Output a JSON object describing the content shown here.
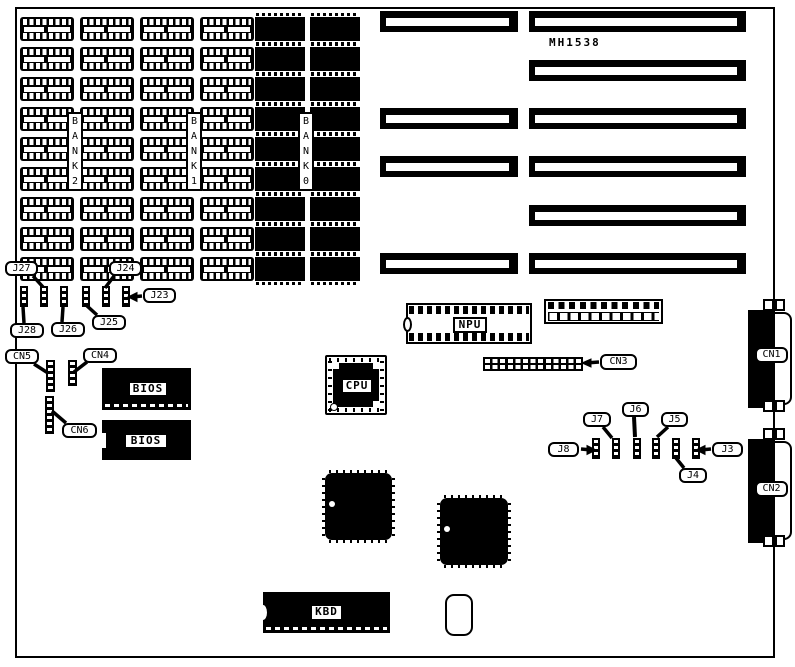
{
  "diagram": {
    "model": "MH1538",
    "memory": {
      "banks": [
        {
          "id": "bank2",
          "label": "BANK2"
        },
        {
          "id": "bank1",
          "label": "BANK1"
        },
        {
          "id": "bank0",
          "label": "BANK0"
        }
      ],
      "empty_socket_grid": {
        "rows": 9,
        "cols": 4
      },
      "populated_chip_grid": {
        "rows": 9,
        "cols": 2
      }
    },
    "expansion_slots": {
      "rows": 6,
      "left_segment_rows": [
        1,
        3,
        4,
        6
      ],
      "right_segment_rows": [
        1,
        2,
        3,
        4,
        5,
        6
      ]
    },
    "chips": {
      "npu": "NPU",
      "cpu": "CPU",
      "bios_top": "BIOS",
      "bios_bottom": "BIOS",
      "keyboard": "KBD"
    },
    "connectors": {
      "cn1": "CN1",
      "cn2": "CN2",
      "cn3": "CN3",
      "cn4": "CN4",
      "cn5": "CN5",
      "cn6": "CN6"
    },
    "jumpers": {
      "j3": "J3",
      "j4": "J4",
      "j5": "J5",
      "j6": "J6",
      "j7": "J7",
      "j8": "J8",
      "j23": "J23",
      "j24": "J24",
      "j25": "J25",
      "j26": "J26",
      "j27": "J27",
      "j28": "J28"
    },
    "colors": {
      "ink": "#000000",
      "paper": "#ffffff"
    }
  }
}
